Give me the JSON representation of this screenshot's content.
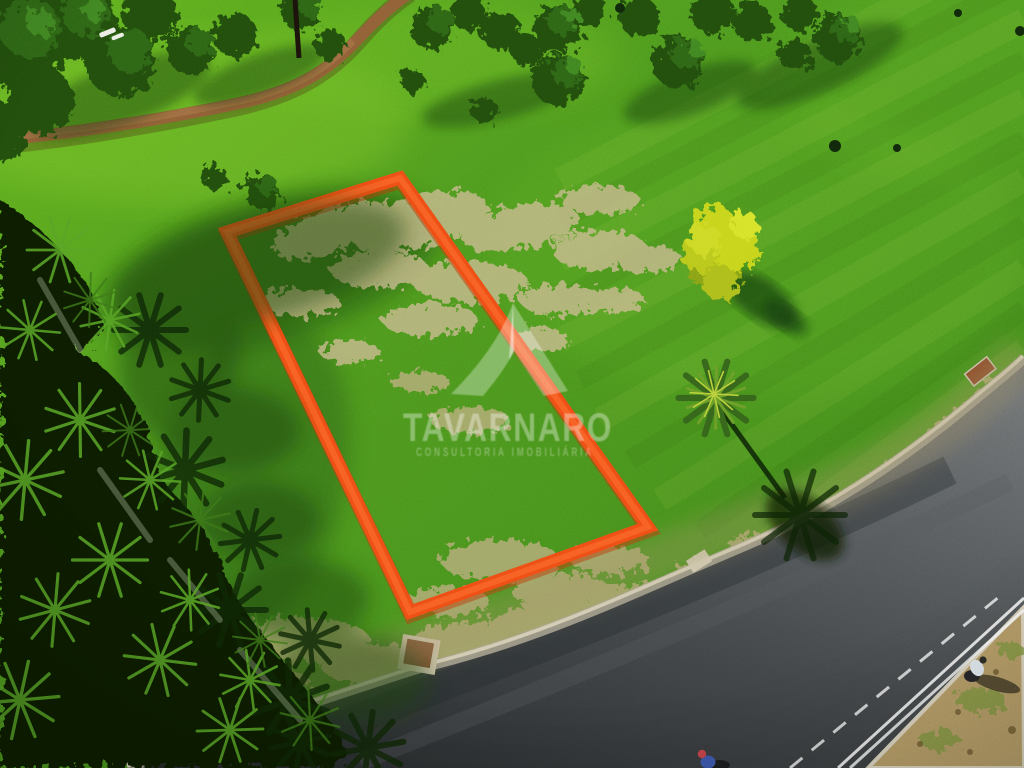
{
  "scene": {
    "type": "aerial-drone-photograph",
    "subject": "vacant residential land plot outlined in orange on mowed green lawn beside a curved asphalt road, palm trees at left, walking path at top"
  },
  "watermark": {
    "brand": "TAVARNARO",
    "tagline": "CONSULTORIA IMOBILIÁRIA",
    "logo": "mountain-a-logo"
  },
  "colors": {
    "plot_outline": "#ee4d15",
    "plot_outline_shadow": "#b83a0c",
    "watermark": "#ffffff",
    "grass": "#4f9a1e",
    "dry_grass": "#c3b084",
    "road": "#42464a",
    "dirt_path": "#8f5f36",
    "palm_foliage": "#0d1d06",
    "lane_marking": "#ffffff"
  }
}
